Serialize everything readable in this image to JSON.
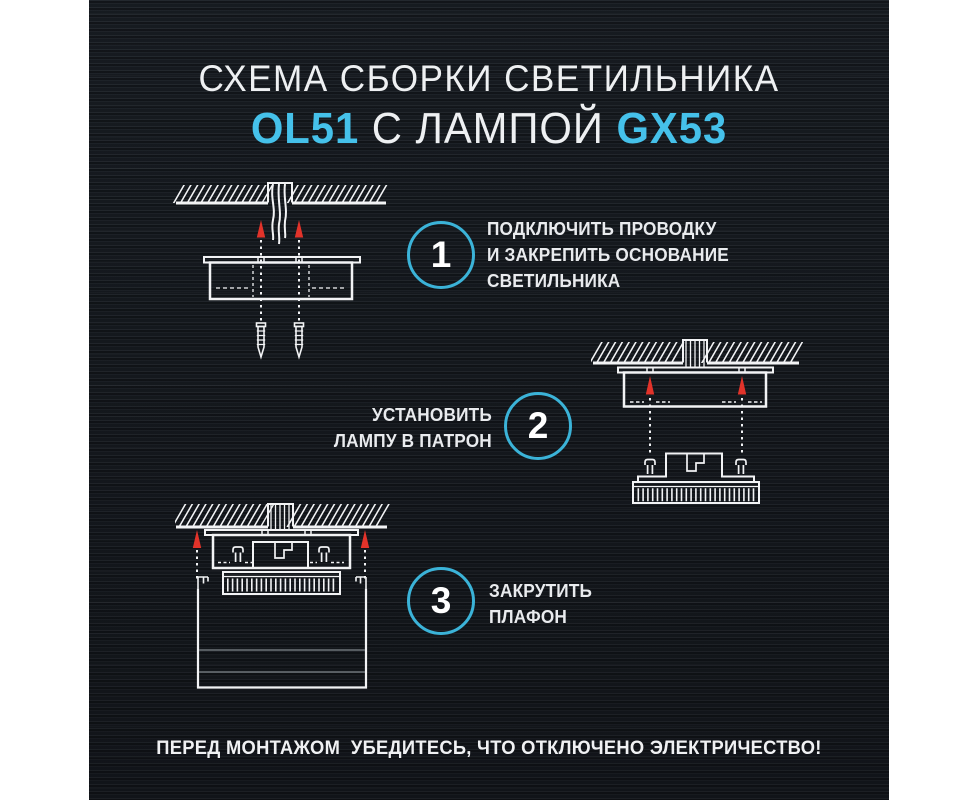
{
  "poster": {
    "title": {
      "line1": "СХЕМА СБОРКИ СВЕТИЛЬНИКА",
      "model": "OL51",
      "middle": " С ЛАМПОЙ ",
      "lamp": "GX53"
    },
    "steps": [
      {
        "number": "1",
        "lines": [
          "ПОДКЛЮЧИТЬ ПРОВОДКУ",
          "И ЗАКРЕПИТЬ ОСНОВАНИЕ",
          "СВЕТИЛЬНИКА"
        ]
      },
      {
        "number": "2",
        "lines": [
          "УСТАНОВИТЬ",
          "ЛАМПУ В ПАТРОН"
        ]
      },
      {
        "number": "3",
        "lines": [
          "ЗАКРУТИТЬ",
          "ПЛАФОН"
        ]
      }
    ],
    "warning": "ПЕРЕД МОНТАЖОМ  УБЕДИТЕСЬ, ЧТО ОТКЛЮЧЕНО ЭЛЕКТРИЧЕСТВО!",
    "colors": {
      "accent_cyan": "#45c1ea",
      "circle_ring": "#3bb3d8",
      "arrow_red": "#e2332a",
      "line_white": "#f2f3f5",
      "panel_background": "#171b20"
    },
    "icons": [
      "ceiling-hatch",
      "wires-icon",
      "up-arrow-icon",
      "screw-icon",
      "gx53-lamp-icon",
      "plafond-icon"
    ]
  }
}
